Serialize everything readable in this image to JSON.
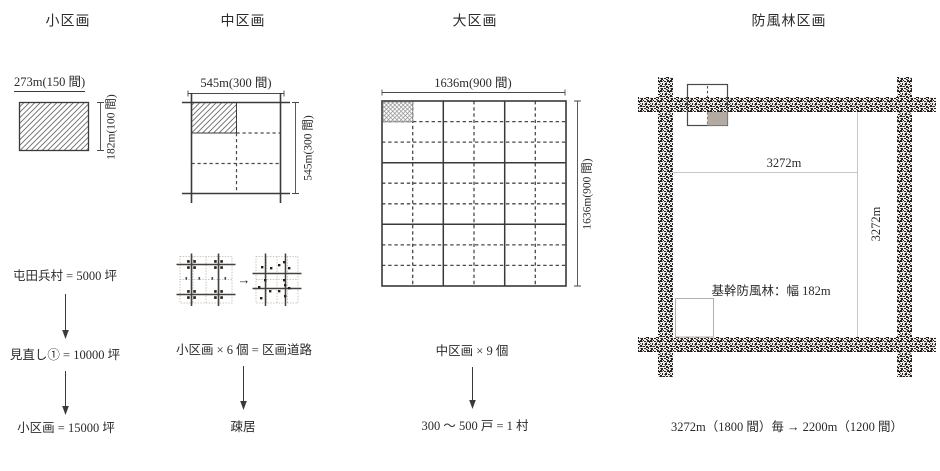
{
  "columns": {
    "small": {
      "title": "小区画",
      "top_dim": "273m(150 間)",
      "side_dim": "182m(100 間)",
      "flow_step1": "屯田兵村 = 5000 坪",
      "flow_step2": "見直し① = 10000 坪",
      "flow_step3": "小区画 = 15000 坪"
    },
    "medium": {
      "title": "中区画",
      "top_dim": "545m(300 間)",
      "side_dim": "545m(300 間)",
      "mini_arrow": "→",
      "equation": "小区画 × 6 個 = 区画道路",
      "result": "疎居"
    },
    "large": {
      "title": "大区画",
      "top_dim": "1636m(900 間)",
      "side_dim": "1636m(900 間)",
      "equation": "中区画 × 9 個",
      "result": "300 〜 500 戸 = 1 村"
    },
    "windbreak": {
      "title": "防風林区画",
      "width_dim": "3272m",
      "height_dim": "3272m",
      "forest_label": "基幹防風林：幅 182m",
      "spacing_note": "3272m（1800 間）毎 → 2200m（1200 間）"
    }
  },
  "colors": {
    "line": "#3a3a3a",
    "dashed_line": "#4a4a4a",
    "light_line": "#c9c5c0",
    "forest_texture": "#262220",
    "gray_cell": "#b3aba2",
    "background": "#ffffff"
  }
}
